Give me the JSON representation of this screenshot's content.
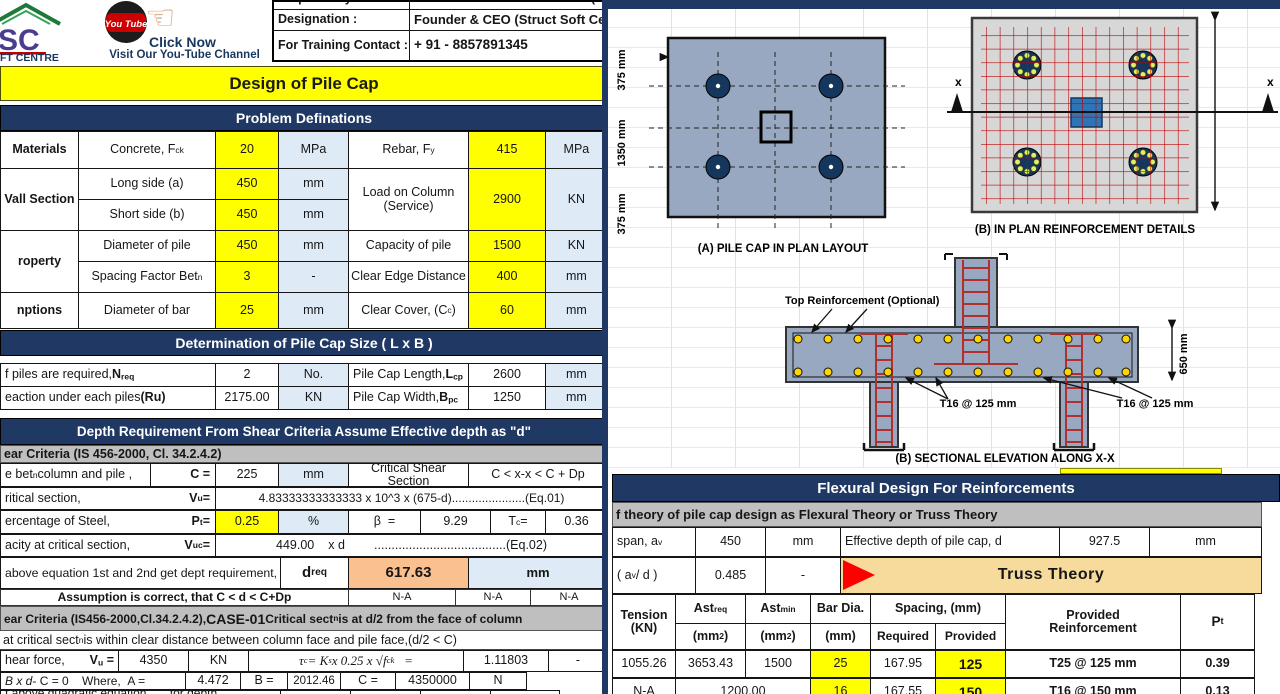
{
  "header": {
    "logo_caption": "FT CENTRE",
    "youtube_badge": "You Tube",
    "click_now": "Click Now",
    "channel_line": "Visit Our You-Tube Channel",
    "contact_rows": [
      {
        "label": "Prepared By:",
        "value": "Mr. ZIYAURRAHMAN ANSARI (M-Te"
      },
      {
        "label": "Designation :",
        "value": "Founder & CEO (Struct Soft Cen"
      },
      {
        "label": "For Training Contact :",
        "value": "+ 91 - 8857891345"
      }
    ]
  },
  "title_banner": "Design of Pile Cap",
  "problem": {
    "section_title": "Problem Definations",
    "rows": [
      {
        "group": "Materials",
        "p1": "Concrete, F<sub>ck</sub>",
        "v1": "20",
        "u1": "MPa",
        "p2": "Rebar, F<sub>y</sub>",
        "v2": "415",
        "u2": "MPa"
      },
      {
        "group": "Vall Section",
        "p1": "Long side (a)",
        "v1": "450",
        "u1": "mm",
        "p2": "Load on Column (Service)",
        "v2": "2900",
        "u2": "KN"
      },
      {
        "p1": "Short side (b)",
        "v1": "450",
        "u1": "mm"
      },
      {
        "group": "roperty",
        "p1": "Diameter of pile",
        "v1": "450",
        "u1": "mm",
        "p2": "Capacity of pile",
        "v2": "1500",
        "u2": "KN"
      },
      {
        "p1": "Spacing Factor Bet<sup>n</sup>",
        "v1": "3",
        "u1": "-",
        "p2": "Clear Edge Distance",
        "v2": "400",
        "u2": "mm"
      },
      {
        "group": "nptions",
        "p1": "Diameter of bar",
        "v1": "25",
        "u1": "mm",
        "p2": "Clear Cover, (C<sub>c</sub>)",
        "v2": "60",
        "u2": "mm"
      }
    ]
  },
  "determination": {
    "section_title": "Determination of Pile Cap Size ( L x B )",
    "rows": [
      {
        "label": "f piles are required, <b>N<sub>req</sub></b>",
        "v": "2",
        "u": "No.",
        "label2": "Pile Cap Length, <b>L<sub>cp</sub></b>",
        "v2": "2600",
        "u2": "mm"
      },
      {
        "label": "eaction under each piles <b>(Ru)</b>",
        "v": "2175.00",
        "u": "KN",
        "label2": "Pile Cap Width, <b>B<sub>pc</sub></b>",
        "v2": "1250",
        "u2": "mm"
      }
    ]
  },
  "shear": {
    "section_title": "Depth Requirement From Shear Criteria Assume Effective depth as \"d\"",
    "criteria_1": "ear Criteria (IS 456-2000, Cl. 34.2.4.2)",
    "row_c": {
      "label": "e bet<sup>n</sup> column and pile ,",
      "sym": "C =",
      "v": "225",
      "u": "mm",
      "r1": "Critical Shear Section",
      "r2": "C < x-x < C + Dp"
    },
    "row_vu": {
      "label": "ritical section,",
      "sym": "V<sub>u</sub> =",
      "formula": "4.83333333333333 x 10^3 x (675-d)......................(Eq.01)"
    },
    "row_pt": {
      "label": "ercentage of Steel,",
      "sym": "P<sub>t</sub> =",
      "v": "0.25",
      "u": "%",
      "beta_label": "β  =",
      "beta": "9.29",
      "tc_label": "T<sub>c</sub> =",
      "tc": "0.36"
    },
    "row_vuc": {
      "label": "acity at critical section,",
      "sym": "V<sub>uc</sub> =",
      "v": "449.00",
      "xd": "x d",
      "eq": "......................................(Eq.02)"
    },
    "row_dreq": {
      "label": "above equation 1st and 2nd get dept requirement,",
      "sym": "d<sub>req</sub>",
      "v": "617.63",
      "u": "mm"
    },
    "row_assume": {
      "label": "Assumption is correct, that C < d < C+Dp",
      "na1": "N-A",
      "na2": "N-A",
      "na3": "N-A"
    },
    "criteria_2": "ear Criteria (IS456-2000,Cl.34.2.4.2), <span class=\"big\">CASE-01</span> Critical sect<sup>n</sup> is at d/2 from the face of column",
    "note": "at critical sect<sup>n</sup> is within clear distance between column face and pile face,(d/2 < C)",
    "row_vu2": {
      "label": "hear force,",
      "sym": "V<sub>u</sub> =",
      "v": "4350",
      "u": "KN",
      "formula": "τ<sub>c</sub> = K<sub>s</sub> x 0.25 x √f<sub>ck</sub>   =",
      "val": "1.11803",
      "dash": "-"
    },
    "row_quad": {
      "label": "<i>B x d</i> - C = 0    Where,  A =",
      "a": "4.472",
      "b_label": "B =",
      "b": "2012.46",
      "c_label": "C =",
      "c": "4350000",
      "n": "N"
    },
    "row_roots": {
      "label": "f above quadratic equation sect<sup>n</sup> for depth requirement",
      "v1": "786.50",
      "u1": "mm",
      "v2": "1226.50",
      "u2": "mm"
    }
  },
  "flexural": {
    "section_title": "Flexural Design For Reinforcements",
    "criteria": "f theory of pile cap design as Flexural Theory or Truss Theory",
    "row1": {
      "label": "span, a<sub>v</sub>",
      "v": "450",
      "u": "mm",
      "label2": "Effective depth of pile cap, d",
      "v2": "927.5",
      "u2": "mm"
    },
    "row2": {
      "label": "( a<sub>v</sub>/ d )",
      "v": "0.485",
      "u": "-",
      "result": "Truss Theory"
    },
    "table": {
      "headers": {
        "tension": "Tension<br>(KN)",
        "astreq": "Ast<sub>req</sub>",
        "astreq_u": "(mm<sup>2</sup>)",
        "astmin": "Ast<sub>min</sub>",
        "astmin_u": "(mm<sup>2</sup>)",
        "bardia": "Bar Dia.",
        "bardia_u": "(mm)",
        "spacing": "Spacing, (mm)",
        "required": "Required",
        "provided": "Provided",
        "reinf": "Provided<br>Reinforcement",
        "pt": "P<sub>t</sub>"
      },
      "rows": [
        {
          "tension": "1055.26",
          "astreq": "3653.43",
          "astmin": "1500",
          "dia": "25",
          "req": "167.95",
          "prov": "125",
          "reinf": "T25 @ 125  mm",
          "pt": "0.39"
        },
        {
          "tension": "N-A",
          "ast_merged": "1200.00",
          "dia": "16",
          "req": "167.55",
          "prov": "150",
          "reinf": "T16 @ 150  mm",
          "pt": "0.13"
        }
      ]
    }
  },
  "diagrams": {
    "plan": {
      "caption": "(A) PILE CAP IN PLAN LAYOUT",
      "dim_top_left": "375 mm",
      "dim_top_mid": "1350 mm",
      "dim_top_right": "375 mm",
      "dim_left_top": "375 mm",
      "dim_left_mid": "1350 mm",
      "dim_left_bot": "375 mm"
    },
    "reinf": {
      "caption": "(B) IN PLAN REINFORCEMENT DETAILS",
      "axis_left": "x",
      "axis_right": "x"
    },
    "elevation": {
      "caption": "(B) SECTIONAL ELEVATION ALONG X-X",
      "top_label": "Top Reinforcement (Optional)",
      "t16_left": "T16 @ 125  mm",
      "t16_right": "T16 @ 125  mm",
      "dim": "650   mm"
    }
  },
  "colors": {
    "accent_navy": "#1F3864",
    "highlight_yellow": "#FFFF00",
    "unit_blue": "#DEEAF6",
    "result_orange": "#FAC090",
    "header_gray": "#BFBFBF",
    "truss_tan": "#F6DB9C",
    "rebar_red": "#C00000",
    "cap_fill": "#98A8C0",
    "pile_navy": "#16375D",
    "column_blue": "#2E75B6"
  }
}
